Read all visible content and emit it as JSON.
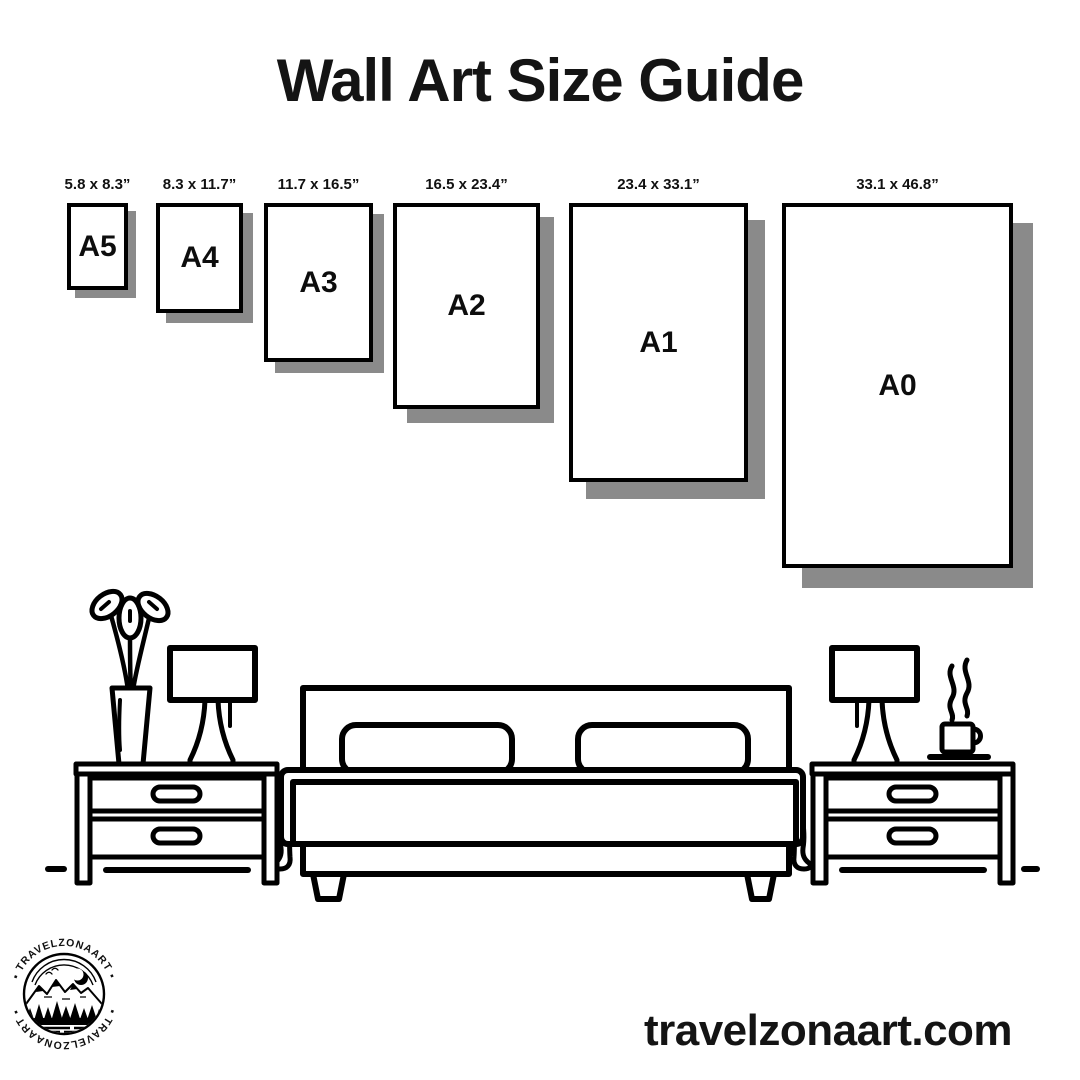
{
  "title": "Wall Art Size Guide",
  "sizes": [
    {
      "name": "A5",
      "dimensions": "5.8 x 8.3”"
    },
    {
      "name": "A4",
      "dimensions": "8.3 x 11.7”"
    },
    {
      "name": "A3",
      "dimensions": "11.7 x 16.5”"
    },
    {
      "name": "A2",
      "dimensions": "16.5 x 23.4”"
    },
    {
      "name": "A1",
      "dimensions": "23.4 x 33.1”"
    },
    {
      "name": "A0",
      "dimensions": "33.1 x 46.8”"
    }
  ],
  "logo": {
    "ring_text_top": "▪ TRAVELZONAART ▪",
    "ring_text_bottom": "▪ TRAVELZONAART ▪"
  },
  "website": "travelzonaart.com",
  "colors": {
    "ink": "#000000",
    "shadow": "#8a8a8a",
    "background": "#ffffff"
  }
}
